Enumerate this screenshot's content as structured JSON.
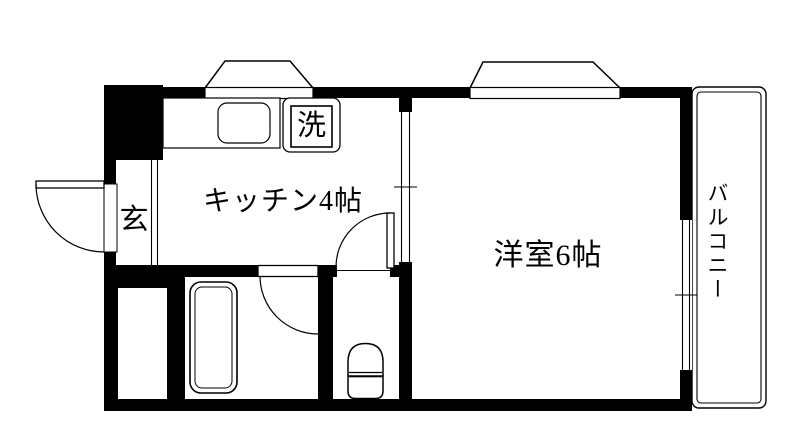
{
  "floorplan": {
    "labels": {
      "kitchen": "キッチン4帖",
      "western_room": "洋室6帖",
      "entrance": "玄",
      "washer": "洗",
      "balcony": "バルコニー"
    },
    "colors": {
      "wall": "#000000",
      "background": "#ffffff",
      "line": "#000000"
    }
  }
}
